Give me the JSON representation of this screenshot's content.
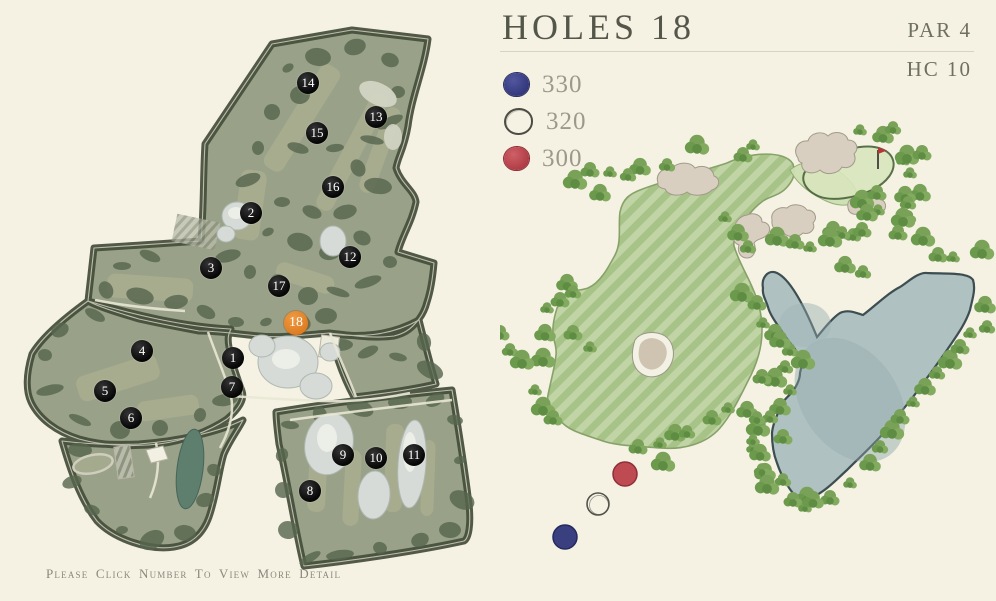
{
  "header": {
    "title": "HOLES 18",
    "par_label": "PAR 4",
    "handicap_label": "HC 10"
  },
  "legend": {
    "items": [
      {
        "id": "blue-tee",
        "distance": "330",
        "color": "#3a3f85"
      },
      {
        "id": "white-tee",
        "distance": "320",
        "color": "#f6f3e7"
      },
      {
        "id": "red-tee",
        "distance": "300",
        "color": "#bd4850"
      }
    ]
  },
  "course_map": {
    "selected_hole": "18",
    "markers": [
      {
        "label": "1",
        "x": 233,
        "y": 358
      },
      {
        "label": "2",
        "x": 251,
        "y": 213
      },
      {
        "label": "3",
        "x": 211,
        "y": 268
      },
      {
        "label": "4",
        "x": 142,
        "y": 351
      },
      {
        "label": "5",
        "x": 105,
        "y": 391
      },
      {
        "label": "6",
        "x": 131,
        "y": 418
      },
      {
        "label": "7",
        "x": 232,
        "y": 387
      },
      {
        "label": "8",
        "x": 310,
        "y": 491
      },
      {
        "label": "9",
        "x": 343,
        "y": 455
      },
      {
        "label": "10",
        "x": 376,
        "y": 458
      },
      {
        "label": "11",
        "x": 414,
        "y": 455
      },
      {
        "label": "12",
        "x": 350,
        "y": 257
      },
      {
        "label": "13",
        "x": 376,
        "y": 117
      },
      {
        "label": "14",
        "x": 308,
        "y": 83
      },
      {
        "label": "15",
        "x": 317,
        "y": 133
      },
      {
        "label": "16",
        "x": 333,
        "y": 187
      },
      {
        "label": "17",
        "x": 279,
        "y": 286
      },
      {
        "label": "18",
        "x": 296,
        "y": 323,
        "selected": true
      }
    ]
  },
  "hole_detail": {
    "tees": [
      {
        "id": "red",
        "x": 125,
        "y": 474
      },
      {
        "id": "white",
        "x": 98,
        "y": 504
      },
      {
        "id": "blue",
        "x": 65,
        "y": 537
      }
    ]
  },
  "footer": {
    "instruction": "Please Click Number To View More Detail"
  },
  "colors": {
    "background": "#f5f2e3",
    "selected_marker_orange": "#de7d23",
    "marker_black": "#0c0c0c",
    "title_text": "#55564a"
  }
}
